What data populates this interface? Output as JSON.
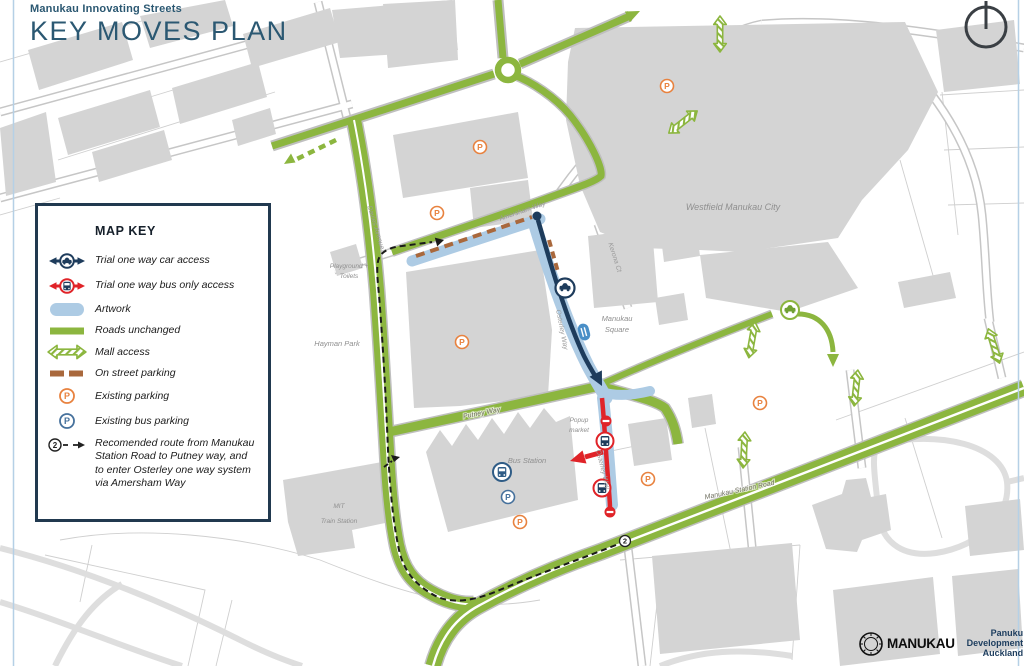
{
  "header": {
    "subtitle": "Manukau Innovating Streets",
    "title": "KEY MOVES PLAN"
  },
  "legend": {
    "title": "MAP KEY",
    "items": [
      {
        "label": "Trial one way car access"
      },
      {
        "label": "Trial one way bus only access"
      },
      {
        "label": "Artwork"
      },
      {
        "label": "Roads unchanged"
      },
      {
        "label": "Mall access"
      },
      {
        "label": "On street parking"
      },
      {
        "label": "Existing parking"
      },
      {
        "label": "Existing bus parking"
      },
      {
        "label": "Recomended route from Manukau Station Road to Putney way, and to enter Osterley one way system via Amersham Way"
      }
    ]
  },
  "map": {
    "places": {
      "westfield": "Westfield Manukau City",
      "manukau_square_1": "Manukau",
      "manukau_square_2": "Square",
      "hayman_park": "Hayman Park",
      "playground_1": "Playground +",
      "playground_2": "Toilets",
      "bus_station": "Bus Station",
      "mit_1": "MIT",
      "mit_2": "Train Station",
      "popup_1": "Popup",
      "popup_2": "market"
    },
    "streets": {
      "davies": "Davies Avenue",
      "amersham": "Amersham Way",
      "osterley": "Osterley Way",
      "putney": "Putney Way",
      "manukau_station_road": "Manukau Station Road",
      "kerona": "Kerona Ct"
    },
    "markers": {
      "parking_letter": "P",
      "route_number": "2"
    }
  },
  "footer": {
    "manukau": "MANUKAU",
    "panuku_1": "Panuku",
    "panuku_2": "Development",
    "panuku_3": "Auckland"
  },
  "colors": {
    "navy_route": "#1e3c5c",
    "red_route": "#e02328",
    "road_green": "#8cb63f",
    "artwork_blue": "#adcbe4",
    "parking_orange": "#e8823f",
    "bus_parking_blue": "#46719c",
    "onstreet_brown": "#a9683c",
    "title_blue": "#2b5872"
  }
}
